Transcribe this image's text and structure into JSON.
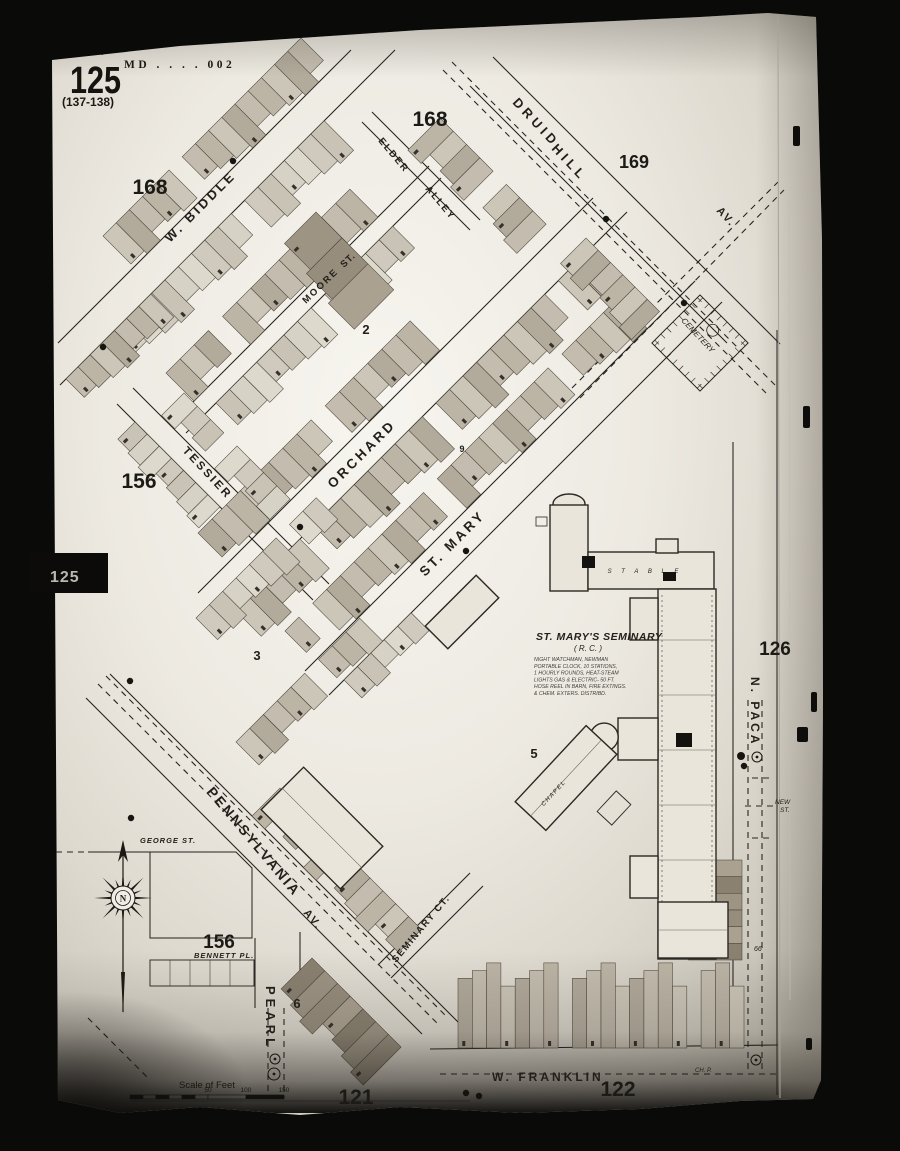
{
  "sheet": {
    "script_note": "Baltimore Md. Vol. 2",
    "code": "MD . . . . 002",
    "number": "125",
    "plate_range": "(137-138)",
    "tab_label": "125"
  },
  "map": {
    "area_numbers": [
      {
        "text": "168",
        "x": 430,
        "y": 126,
        "size": 21
      },
      {
        "text": "168",
        "x": 150,
        "y": 194,
        "size": 21
      },
      {
        "text": "169",
        "x": 634,
        "y": 168,
        "size": 18
      },
      {
        "text": "156",
        "x": 139,
        "y": 488,
        "size": 21
      },
      {
        "text": "156",
        "x": 219,
        "y": 948,
        "size": 19
      },
      {
        "text": "126",
        "x": 775,
        "y": 655,
        "size": 19
      },
      {
        "text": "121",
        "x": 356,
        "y": 1104,
        "size": 21
      },
      {
        "text": "122",
        "x": 618,
        "y": 1096,
        "size": 21
      }
    ],
    "block_numbers": [
      {
        "text": "2",
        "x": 366,
        "y": 334
      },
      {
        "text": "3",
        "x": 257,
        "y": 660
      },
      {
        "text": "5",
        "x": 534,
        "y": 758
      },
      {
        "text": "6",
        "x": 297,
        "y": 1008
      },
      {
        "text": "9",
        "x": 462,
        "y": 452
      }
    ],
    "street_labels": [
      {
        "text": "W. BIDDLE",
        "x": 170,
        "y": 243,
        "rot": -45,
        "size": 13,
        "ls": 3
      },
      {
        "text": "DRUID",
        "x": 512,
        "y": 103,
        "rot": 47,
        "size": 13,
        "ls": 4
      },
      {
        "text": "HILL",
        "x": 551,
        "y": 149,
        "rot": 47,
        "size": 13,
        "ls": 4
      },
      {
        "text": "AV.",
        "x": 716,
        "y": 211,
        "rot": 47,
        "size": 11,
        "ls": 2
      },
      {
        "text": "ELDER",
        "x": 378,
        "y": 141,
        "rot": 50,
        "size": 9.5,
        "ls": 2
      },
      {
        "text": "ALLEY",
        "x": 425,
        "y": 189,
        "rot": 50,
        "size": 9.5,
        "ls": 2
      },
      {
        "text": "MOORE",
        "x": 306,
        "y": 304,
        "rot": -44,
        "size": 9.5,
        "ls": 2
      },
      {
        "text": "ST.",
        "x": 344,
        "y": 268,
        "rot": -44,
        "size": 9.5,
        "ls": 1
      },
      {
        "text": "ORCHARD",
        "x": 333,
        "y": 489,
        "rot": -45,
        "size": 13.5,
        "ls": 3
      },
      {
        "text": "TESSIER",
        "x": 182,
        "y": 451,
        "rot": 47,
        "size": 11.5,
        "ls": 2.5
      },
      {
        "text": "ST. MARY",
        "x": 425,
        "y": 577,
        "rot": -45,
        "size": 13.5,
        "ls": 3
      },
      {
        "text": "PENNSYLVANIA",
        "x": 206,
        "y": 792,
        "rot": 50,
        "size": 14,
        "ls": 2.5
      },
      {
        "text": "AV.",
        "x": 303,
        "y": 913,
        "rot": 50,
        "size": 11,
        "ls": 2
      },
      {
        "text": "SEMINARY CT.",
        "x": 396,
        "y": 963,
        "rot": -50,
        "size": 9.5,
        "ls": 1.5
      },
      {
        "text": "PEARL",
        "x": 266,
        "y": 986,
        "rot": 90,
        "size": 13,
        "ls": 4
      },
      {
        "text": "N. PACA",
        "x": 751,
        "y": 677,
        "rot": 90,
        "size": 12,
        "ls": 3
      },
      {
        "text": "W. FRANKLIN",
        "x": 492,
        "y": 1081,
        "rot": 0,
        "size": 12,
        "ls": 3
      },
      {
        "text": "GEORGE ST.",
        "x": 140,
        "y": 843,
        "rot": 0,
        "size": 7.5,
        "ls": 1,
        "italic": true
      },
      {
        "text": "BENNETT PL.",
        "x": 194,
        "y": 958,
        "rot": 0,
        "size": 7.5,
        "ls": 1,
        "italic": true
      }
    ],
    "poi_labels": [
      {
        "text": "CEMETERY",
        "x": 681,
        "y": 321,
        "rot": 47,
        "size": 8,
        "italic": true
      },
      {
        "text": "NEW",
        "x": 775,
        "y": 804,
        "rot": 0,
        "size": 6.5,
        "italic": true
      },
      {
        "text": "ST.",
        "x": 780,
        "y": 812,
        "rot": 0,
        "size": 6.5,
        "italic": true
      },
      {
        "text": "66",
        "x": 754,
        "y": 951,
        "rot": 0,
        "size": 7,
        "italic": true
      },
      {
        "text": "CH. P.",
        "x": 695,
        "y": 1072,
        "rot": 0,
        "size": 6,
        "italic": true
      }
    ],
    "seminary": {
      "title": "ST. MARY'S SEMINARY",
      "subtitle": "( R. C. )",
      "notes": [
        "NIGHT WATCHMAN, NEWMAN",
        "PORTABLE CLOCK, 10 STATIONS,",
        "1 HOURLY ROUNDS, HEAT-STEAM",
        "LIGHTS GAS & ELECTRIC- 50 FT.",
        "HOSE REEL IN BARN, FIRE EXTINGS.",
        "& CHEM. EXTERS. DISTRIBD."
      ],
      "stable_label": "S T A B L E",
      "chapel_label": "CHAPEL"
    },
    "scale_bar": {
      "label": "Scale of Feet",
      "ticks": [
        "50",
        "100",
        "150"
      ]
    },
    "compass_letter": "N"
  }
}
